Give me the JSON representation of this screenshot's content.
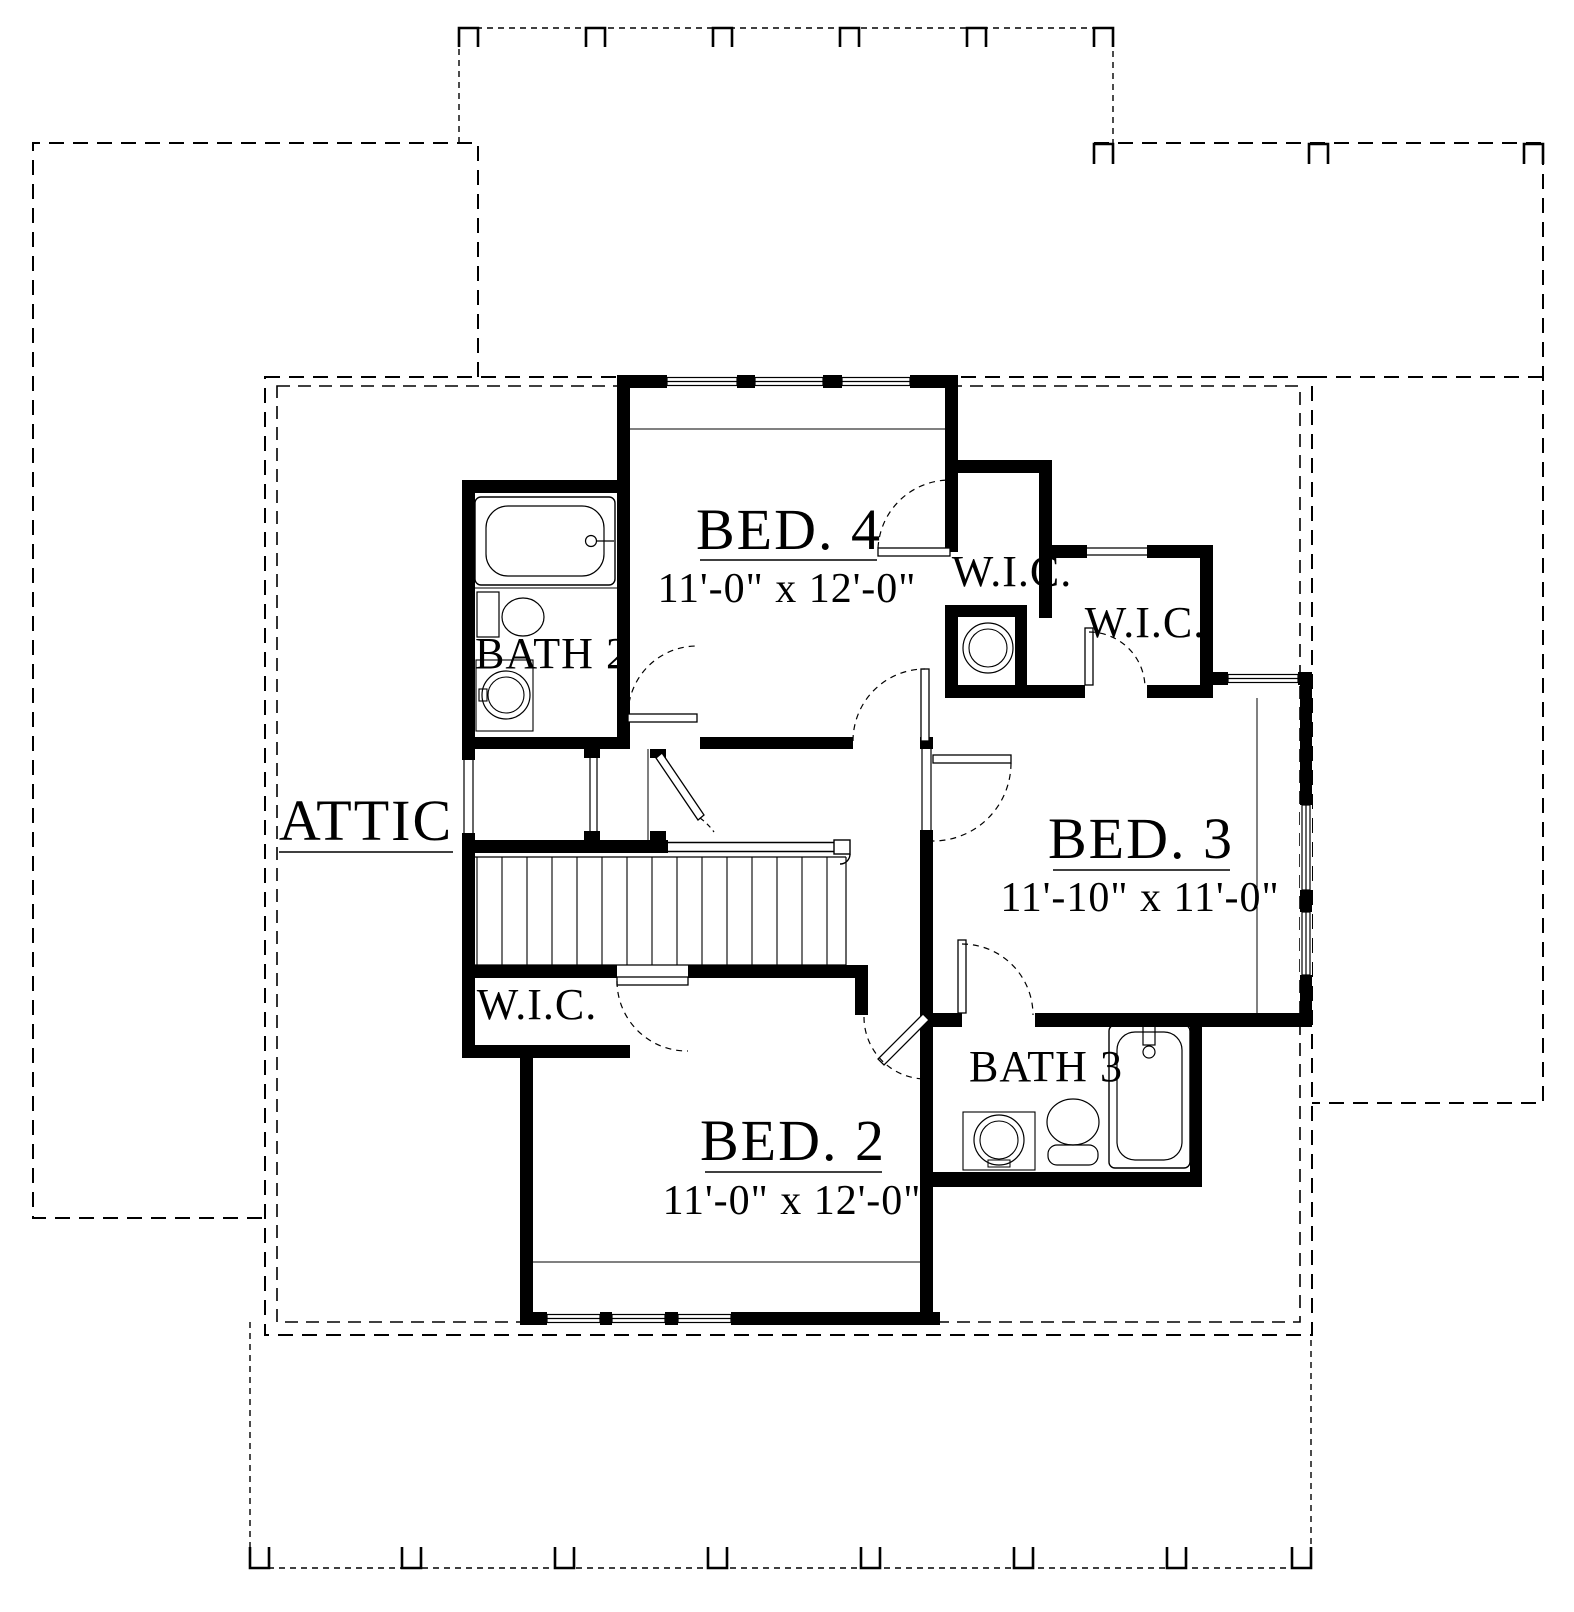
{
  "rooms": {
    "bed4": {
      "label": "BED. 4",
      "dimensions": "11'-0\" x 12'-0\""
    },
    "bed3": {
      "label": "BED. 3",
      "dimensions": "11'-10\" x 11'-0\""
    },
    "bed2": {
      "label": "BED. 2",
      "dimensions": "11'-0\" x 12'-0\""
    },
    "bath2": {
      "label": "BATH 2"
    },
    "bath3": {
      "label": "BATH 3"
    },
    "wic_off_bed4": {
      "label": "W.I.C."
    },
    "wic_off_bed3": {
      "label": "W.I.C."
    },
    "wic_off_bed2": {
      "label": "W.I.C."
    },
    "attic": {
      "label": "ATTIC"
    }
  },
  "colors": {
    "ink": "#000000",
    "paper": "#ffffff"
  }
}
